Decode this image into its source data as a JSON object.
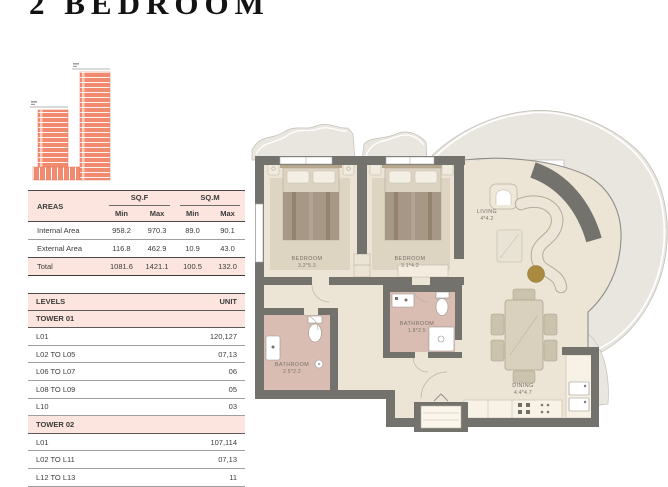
{
  "title": "2 BEDROOM",
  "areas_table": {
    "areas_label": "AREAS",
    "sqf_label": "SQ.F",
    "sqm_label": "SQ.M",
    "min_label": "Min",
    "max_label": "Max",
    "rows": [
      {
        "label": "Internal Area",
        "sqf_min": "958.2",
        "sqf_max": "970.3",
        "sqm_min": "89.0",
        "sqm_max": "90.1"
      },
      {
        "label": "External Area",
        "sqf_min": "116.8",
        "sqf_max": "462.9",
        "sqm_min": "10.9",
        "sqm_max": "43.0"
      },
      {
        "label": "Total",
        "sqf_min": "1081.6",
        "sqf_max": "1421.1",
        "sqm_min": "100.5",
        "sqm_max": "132.0"
      }
    ]
  },
  "levels_table": {
    "levels_label": "LEVELS",
    "unit_label": "UNIT",
    "rows": [
      {
        "label": "TOWER 01",
        "value": ""
      },
      {
        "label": "L01",
        "value": "120,127"
      },
      {
        "label": "L02 TO L05",
        "value": "07,13"
      },
      {
        "label": "L06 TO L07",
        "value": "06"
      },
      {
        "label": "L08 TO L09",
        "value": "05"
      },
      {
        "label": "L10",
        "value": "03"
      },
      {
        "label": "TOWER 02",
        "value": ""
      },
      {
        "label": "L01",
        "value": "107,114"
      },
      {
        "label": "L02 TO L11",
        "value": "07,13"
      },
      {
        "label": "L12 TO L13",
        "value": "11"
      }
    ]
  },
  "floor_plan": {
    "bedroom1": {
      "name": "BEDROOM",
      "dims": "3.2*5.3"
    },
    "bedroom2": {
      "name": "BEDROOM",
      "dims": "3.1*4.2"
    },
    "living": {
      "name": "LIVING",
      "dims": "4*4.2"
    },
    "bathroom1": {
      "name": "BATHROOM",
      "dims": "2.5*2.2"
    },
    "bathroom2": {
      "name": "BATHROOM",
      "dims": "1.8*2.5"
    },
    "dining": {
      "name": "DINING",
      "dims": "4.4*4.7"
    }
  },
  "colors": {
    "accent_pink": "#fbe5de",
    "tower_salmon": "#f18a6e",
    "wall_gray": "#74726c",
    "floor_beige": "#ece4d5",
    "bathroom_pink": "#d9bdb2",
    "balcony_gray": "#e9e6df",
    "ottoman_gold": "#a98a40"
  }
}
